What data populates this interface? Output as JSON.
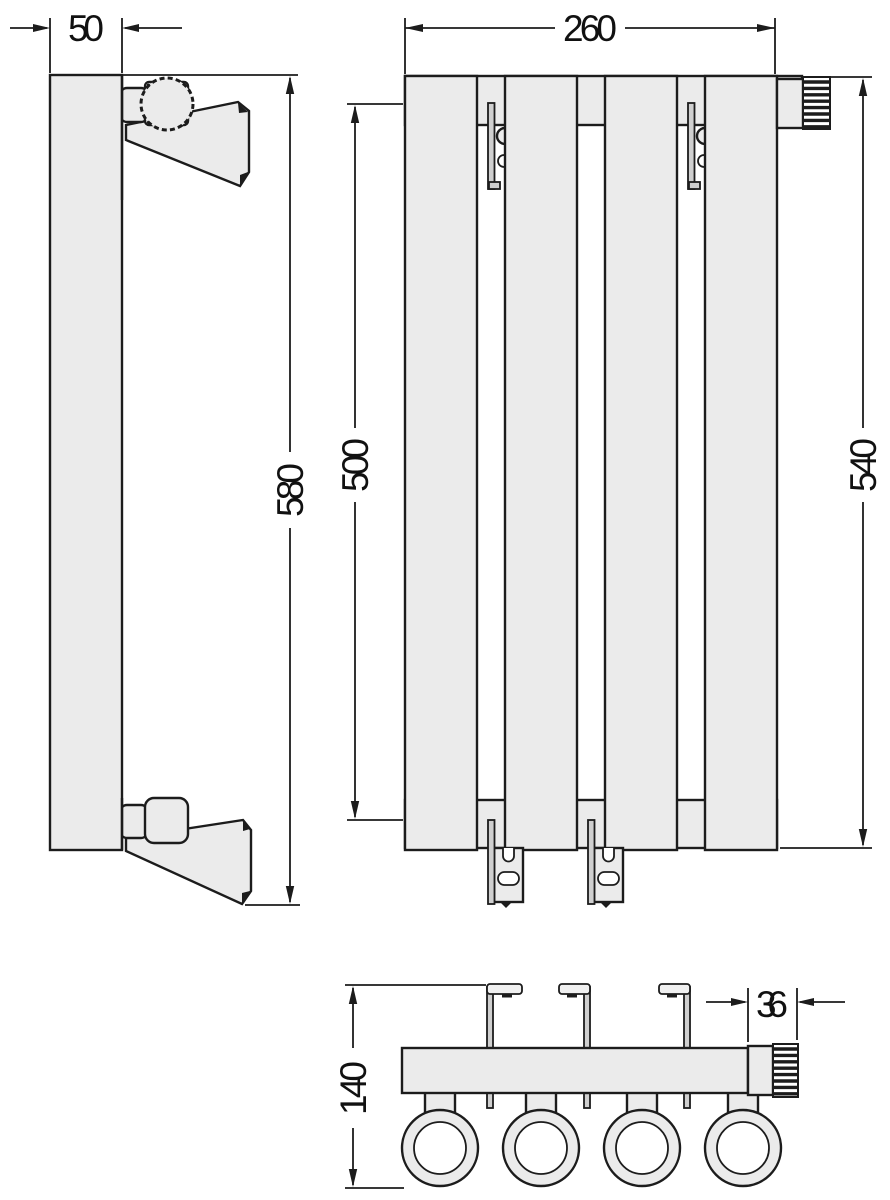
{
  "drawing": {
    "colors": {
      "background": "#ffffff",
      "part_fill": "#ebebeb",
      "line": "#1c1c1c",
      "bracket_pin_fill": "#cfcfcf"
    },
    "views": {
      "side": {
        "dims": {
          "depth": "50",
          "overall_height": "580"
        }
      },
      "front": {
        "dims": {
          "width": "260",
          "bracket_span": "500",
          "body_height": "540"
        }
      },
      "bottom": {
        "dims": {
          "total_depth": "140",
          "valve_width": "36"
        }
      }
    }
  }
}
